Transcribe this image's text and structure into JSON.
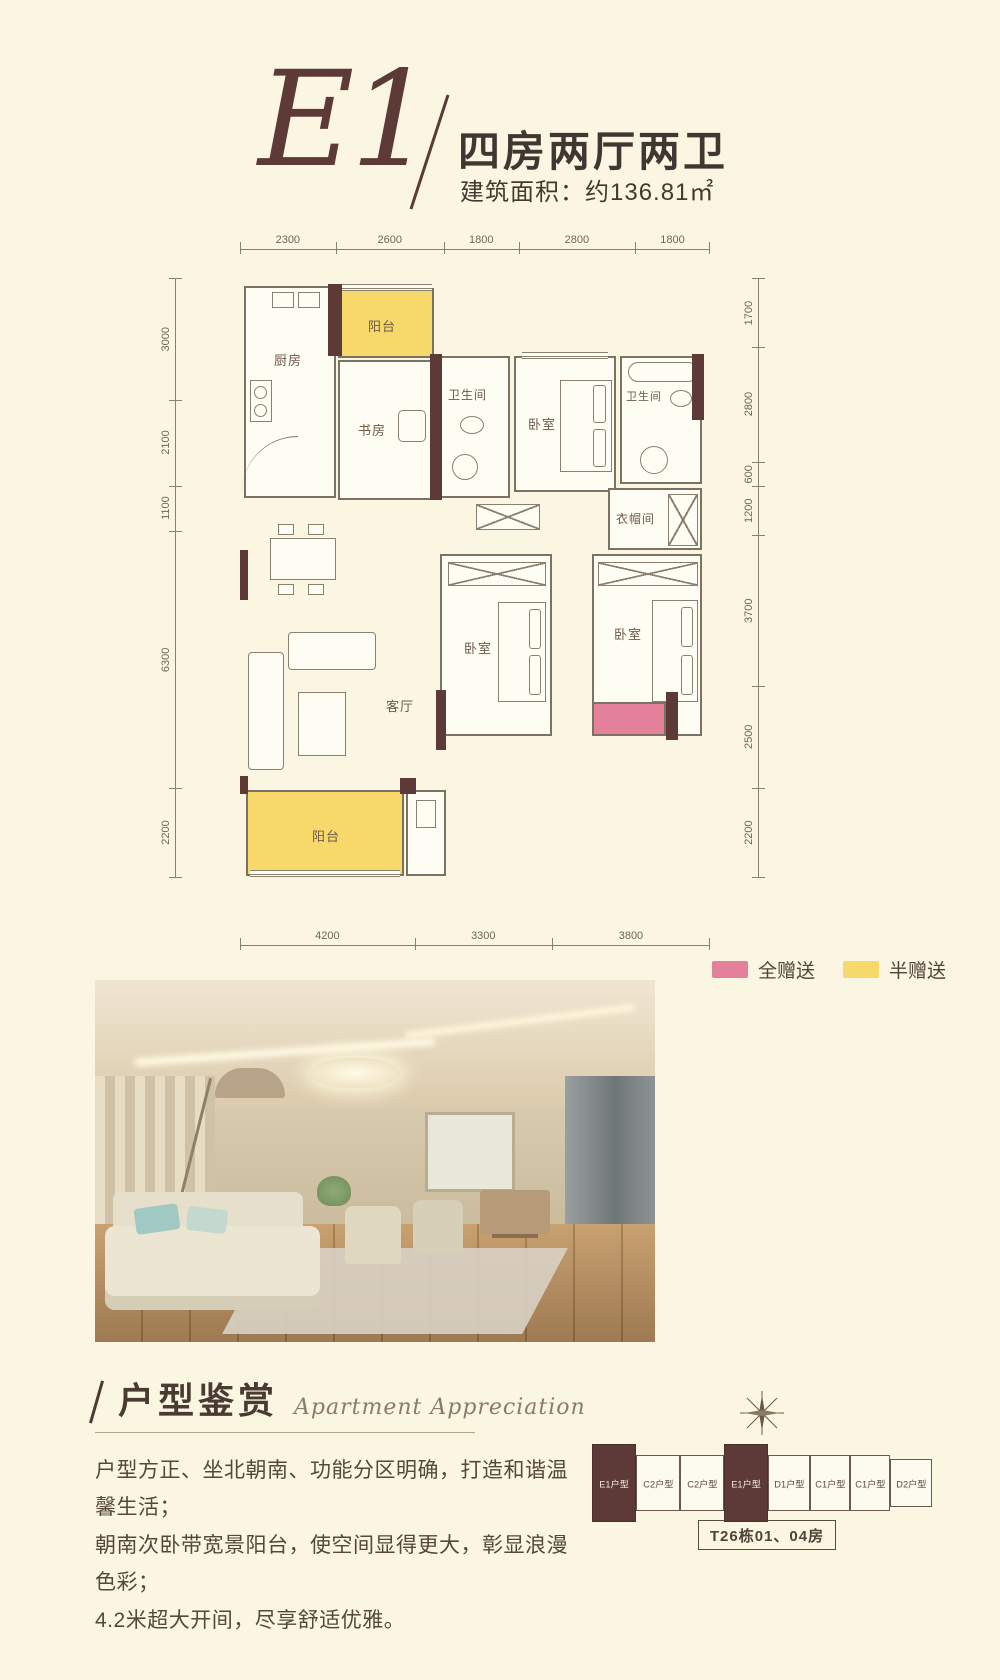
{
  "header": {
    "plan_code": "E1",
    "divider": "/",
    "title": "四房两厅两卫",
    "area_label": "建筑面积：约136.81㎡"
  },
  "floorplan": {
    "rooms": [
      {
        "label": "厨房"
      },
      {
        "label": "阳台"
      },
      {
        "label": "书房"
      },
      {
        "label": "卫生间"
      },
      {
        "label": "卧室"
      },
      {
        "label": "卫生间"
      },
      {
        "label": "衣帽间"
      },
      {
        "label": "餐厅"
      },
      {
        "label": "客厅"
      },
      {
        "label": "卧室"
      },
      {
        "label": "卧室"
      },
      {
        "label": "阳台"
      }
    ],
    "dims_top": [
      "2300",
      "2600",
      "1800",
      "2800",
      "1800"
    ],
    "dims_left": [
      "3000",
      "2100",
      "1100",
      "6300",
      "2200"
    ],
    "dims_right": [
      "1700",
      "2800",
      "600",
      "1200",
      "3700",
      "2500",
      "2200"
    ],
    "dims_bottom": [
      "4200",
      "3300",
      "3800"
    ],
    "legend": [
      {
        "label": "全赠送",
        "color": "#e5809c"
      },
      {
        "label": "半赠送",
        "color": "#f6d96a"
      }
    ]
  },
  "appreciation": {
    "divider": "/",
    "title_cn": "户型鉴赏",
    "title_en": "Apartment Appreciation",
    "lines": [
      "户型方正、坐北朝南、功能分区明确，打造和谐温馨生活；",
      "朝南次卧带宽景阳台，使空间显得更大，彰显浪漫色彩；",
      "4.2米超大开间，尽享舒适优雅。"
    ]
  },
  "key_plan": {
    "units": [
      {
        "label": "E1户型",
        "highlight": true
      },
      {
        "label": "C2户型",
        "highlight": false
      },
      {
        "label": "C2户型",
        "highlight": false
      },
      {
        "label": "E1户型",
        "highlight": true
      },
      {
        "label": "D1户型",
        "highlight": false
      },
      {
        "label": "C1户型",
        "highlight": false
      },
      {
        "label": "C1户型",
        "highlight": false
      },
      {
        "label": "D2户型",
        "highlight": false
      }
    ],
    "building_label": "T26栋01、04房"
  },
  "colors": {
    "background": "#fbf6e1",
    "accent_maroon": "#5d3a37",
    "gift_full_pink": "#e5809c",
    "gift_half_yellow": "#f6d96a"
  }
}
